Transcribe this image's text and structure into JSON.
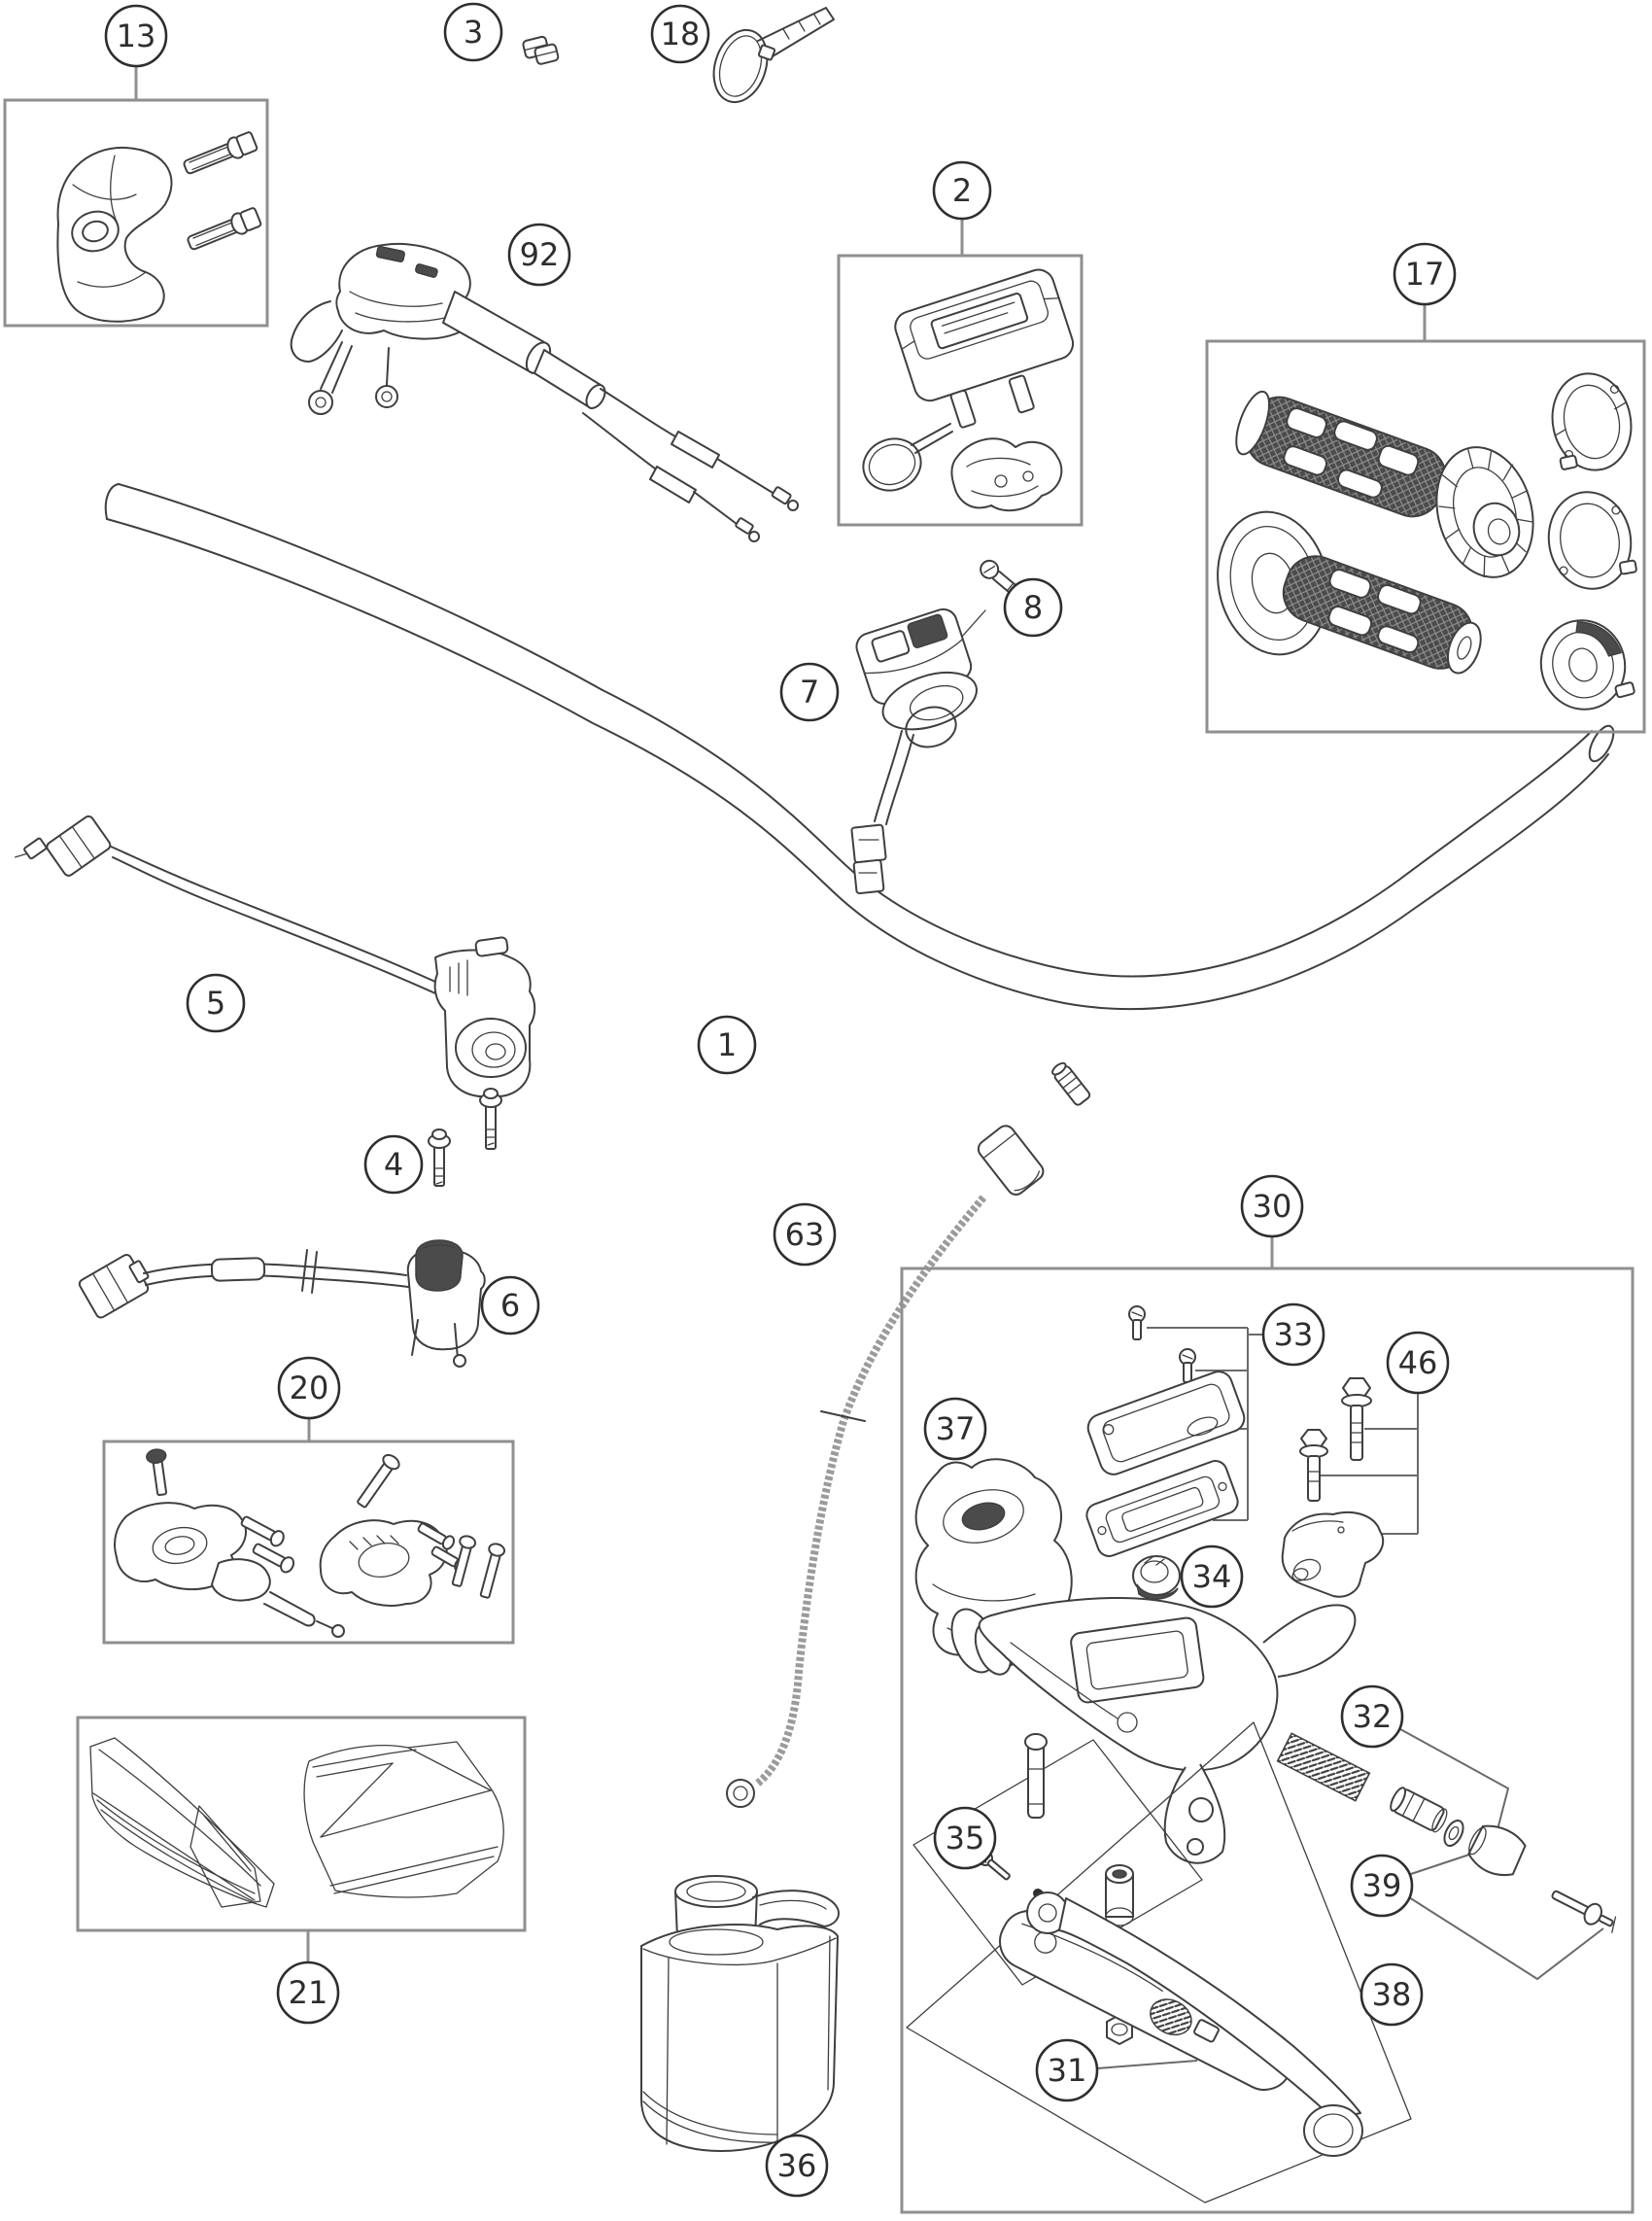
{
  "diagram": {
    "colors": {
      "background": "#ffffff",
      "line": "#3f3f3f",
      "box_border": "#8f8f8f",
      "leader": "#6a6a6a",
      "grip_dark": "#4b4b4b",
      "text": "#2e2e2e"
    },
    "callouts": {
      "c1": {
        "label": "1"
      },
      "c2": {
        "label": "2"
      },
      "c3": {
        "label": "3"
      },
      "c4": {
        "label": "4"
      },
      "c5": {
        "label": "5"
      },
      "c6": {
        "label": "6"
      },
      "c7": {
        "label": "7"
      },
      "c8": {
        "label": "8"
      },
      "c13": {
        "label": "13"
      },
      "c17": {
        "label": "17"
      },
      "c18": {
        "label": "18"
      },
      "c20": {
        "label": "20"
      },
      "c21": {
        "label": "21"
      },
      "c30": {
        "label": "30"
      },
      "c31": {
        "label": "31"
      },
      "c32": {
        "label": "32"
      },
      "c33": {
        "label": "33"
      },
      "c34": {
        "label": "34"
      },
      "c35": {
        "label": "35"
      },
      "c36": {
        "label": "36"
      },
      "c37": {
        "label": "37"
      },
      "c38": {
        "label": "38"
      },
      "c39": {
        "label": "39"
      },
      "c46": {
        "label": "46"
      },
      "c63": {
        "label": "63"
      },
      "c92": {
        "label": "92"
      }
    }
  }
}
